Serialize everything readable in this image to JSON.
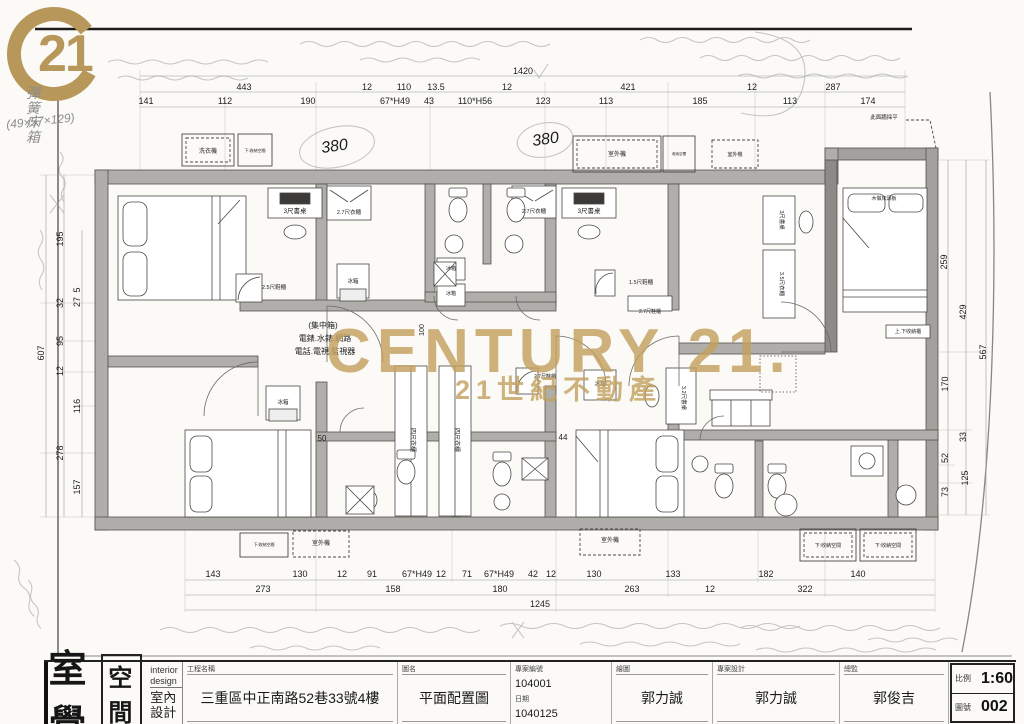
{
  "logo": {
    "number": "21"
  },
  "watermark": {
    "line1": "CENTURY 21.",
    "line2": "21世紀不動產"
  },
  "handwritten": {
    "spec_label": "彈簧床箱",
    "spec_note": "(49×57×129)",
    "circle1": "380",
    "circle2": "380"
  },
  "title_block": {
    "company_name": "室覺",
    "company_box": "空間",
    "company_en": "interior design",
    "company_cn": "室內設計",
    "f_project_label": "工程名稱",
    "f_project_value": "三重區中正南路52巷33號4樓",
    "f_drawing_label": "圖名",
    "f_drawing_value": "平面配置圖",
    "f_case_label": "專案編號",
    "f_case_value": "104001",
    "f_date_label": "日期",
    "f_date_value": "1040125",
    "f_draft_label": "繪圖",
    "f_draft_value": "郭力誠",
    "f_design_label": "專案設計",
    "f_design_value": "郭力誠",
    "f_director_label": "總監",
    "f_director_value": "郭俊吉",
    "f_scale_label": "比例",
    "f_scale_value": "1:60",
    "f_sheet_label": "圖號",
    "f_sheet_value": "002"
  },
  "plan": {
    "dim_labels": [
      {
        "t": "1420",
        "x": 523,
        "y": 74
      },
      {
        "t": "443",
        "x": 244,
        "y": 90
      },
      {
        "t": "12",
        "x": 367,
        "y": 90
      },
      {
        "t": "110",
        "x": 404,
        "y": 90
      },
      {
        "t": "13.5",
        "x": 436,
        "y": 90
      },
      {
        "t": "12",
        "x": 507,
        "y": 90
      },
      {
        "t": "421",
        "x": 628,
        "y": 90
      },
      {
        "t": "12",
        "x": 752,
        "y": 90
      },
      {
        "t": "287",
        "x": 833,
        "y": 90
      },
      {
        "t": "141",
        "x": 146,
        "y": 104
      },
      {
        "t": "112",
        "x": 225,
        "y": 104
      },
      {
        "t": "190",
        "x": 308,
        "y": 104
      },
      {
        "t": "67*H49",
        "x": 395,
        "y": 104
      },
      {
        "t": "43",
        "x": 429,
        "y": 104
      },
      {
        "t": "110*H56",
        "x": 475,
        "y": 104
      },
      {
        "t": "123",
        "x": 543,
        "y": 104
      },
      {
        "t": "113",
        "x": 606,
        "y": 104
      },
      {
        "t": "185",
        "x": 700,
        "y": 104
      },
      {
        "t": "113",
        "x": 790,
        "y": 104
      },
      {
        "t": "174",
        "x": 868,
        "y": 104
      },
      {
        "t": "143",
        "x": 213,
        "y": 577
      },
      {
        "t": "130",
        "x": 300,
        "y": 577
      },
      {
        "t": "12",
        "x": 342,
        "y": 577
      },
      {
        "t": "91",
        "x": 372,
        "y": 577
      },
      {
        "t": "67*H49",
        "x": 417,
        "y": 577
      },
      {
        "t": "12",
        "x": 441,
        "y": 577
      },
      {
        "t": "71",
        "x": 467,
        "y": 577
      },
      {
        "t": "67*H49",
        "x": 499,
        "y": 577
      },
      {
        "t": "42",
        "x": 533,
        "y": 577
      },
      {
        "t": "12",
        "x": 551,
        "y": 577
      },
      {
        "t": "130",
        "x": 594,
        "y": 577
      },
      {
        "t": "133",
        "x": 673,
        "y": 577
      },
      {
        "t": "182",
        "x": 766,
        "y": 577
      },
      {
        "t": "140",
        "x": 858,
        "y": 577
      },
      {
        "t": "273",
        "x": 263,
        "y": 592
      },
      {
        "t": "158",
        "x": 393,
        "y": 592
      },
      {
        "t": "180",
        "x": 500,
        "y": 592
      },
      {
        "t": "263",
        "x": 632,
        "y": 592
      },
      {
        "t": "12",
        "x": 710,
        "y": 592
      },
      {
        "t": "322",
        "x": 805,
        "y": 592
      },
      {
        "t": "1245",
        "x": 540,
        "y": 607
      },
      {
        "t": "607",
        "x": 44,
        "y": 353,
        "r": -90
      },
      {
        "t": "195",
        "x": 63,
        "y": 239,
        "r": -90
      },
      {
        "t": "32",
        "x": 63,
        "y": 303,
        "r": -90
      },
      {
        "t": "5",
        "x": 80,
        "y": 290,
        "r": -90
      },
      {
        "t": "27",
        "x": 80,
        "y": 302,
        "r": -90
      },
      {
        "t": "95",
        "x": 63,
        "y": 341,
        "r": -90
      },
      {
        "t": "12",
        "x": 63,
        "y": 371,
        "r": -90
      },
      {
        "t": "116",
        "x": 80,
        "y": 406,
        "r": -90
      },
      {
        "t": "278",
        "x": 63,
        "y": 453,
        "r": -90
      },
      {
        "t": "157",
        "x": 80,
        "y": 487,
        "r": -90
      },
      {
        "t": "259",
        "x": 947,
        "y": 262,
        "r": -90
      },
      {
        "t": "429",
        "x": 966,
        "y": 312,
        "r": -90
      },
      {
        "t": "567",
        "x": 986,
        "y": 352,
        "r": -90
      },
      {
        "t": "170",
        "x": 948,
        "y": 384,
        "r": -90
      },
      {
        "t": "33",
        "x": 966,
        "y": 437,
        "r": -90
      },
      {
        "t": "52",
        "x": 948,
        "y": 458,
        "r": -90
      },
      {
        "t": "125",
        "x": 968,
        "y": 478,
        "r": -90
      },
      {
        "t": "73",
        "x": 948,
        "y": 492,
        "r": -90
      },
      {
        "t": "50",
        "x": 322,
        "y": 441,
        "s": 8
      },
      {
        "t": "44",
        "x": 563,
        "y": 440,
        "s": 8
      },
      {
        "t": "100",
        "x": 424,
        "y": 330,
        "r": -90,
        "s": 7
      }
    ],
    "room_labels": [
      {
        "t": "洗衣機",
        "x": 208,
        "y": 153,
        "s": 6
      },
      {
        "t": "下:收納空間",
        "x": 255,
        "y": 152,
        "s": 4
      },
      {
        "t": "室外機",
        "x": 617,
        "y": 156,
        "s": 6
      },
      {
        "t": "收納空間",
        "x": 679,
        "y": 155,
        "s": 3.6
      },
      {
        "t": "室外機",
        "x": 735,
        "y": 156,
        "s": 5
      },
      {
        "t": "此面牆採平",
        "x": 884,
        "y": 119,
        "s": 5.5
      },
      {
        "t": "3尺書桌",
        "x": 295,
        "y": 213,
        "s": 6.5
      },
      {
        "t": "2.7尺衣櫃",
        "x": 349,
        "y": 214,
        "s": 5.5
      },
      {
        "t": "3尺書桌",
        "x": 589,
        "y": 213,
        "s": 6.5
      },
      {
        "t": "2.7尺衣櫃",
        "x": 534,
        "y": 213,
        "s": 5.5
      },
      {
        "t": "3尺書桌",
        "x": 780,
        "y": 220,
        "s": 5.5,
        "r": 90
      },
      {
        "t": "3.5尺衣櫃",
        "x": 780,
        "y": 284,
        "s": 5.5,
        "r": 90
      },
      {
        "t": "木做床頭板",
        "x": 884,
        "y": 200,
        "s": 5
      },
      {
        "t": "冰箱",
        "x": 451,
        "y": 270,
        "s": 5
      },
      {
        "t": "冰箱",
        "x": 451,
        "y": 295,
        "s": 5
      },
      {
        "t": "冰箱",
        "x": 353,
        "y": 283,
        "s": 5.5
      },
      {
        "t": "1.5尺鞋櫃",
        "x": 641,
        "y": 284,
        "s": 5.5
      },
      {
        "t": "2.5尺鞋櫃",
        "x": 274,
        "y": 289,
        "s": 5.5
      },
      {
        "t": "2.7尺鞋櫃",
        "x": 650,
        "y": 313,
        "s": 5
      },
      {
        "t": "(集中箱)",
        "x": 323,
        "y": 328,
        "s": 8
      },
      {
        "t": "電錶.水錶.網路",
        "x": 325,
        "y": 341,
        "s": 8
      },
      {
        "t": "電話.電視.監視器",
        "x": 325,
        "y": 354,
        "s": 8
      },
      {
        "t": "四尺衣櫃",
        "x": 411,
        "y": 440,
        "s": 6,
        "r": 90
      },
      {
        "t": "四尺衣櫃",
        "x": 455,
        "y": 440,
        "s": 6,
        "r": 90
      },
      {
        "t": "冰箱",
        "x": 283,
        "y": 404,
        "s": 5.5
      },
      {
        "t": "2.7尺鞋櫃",
        "x": 545,
        "y": 378,
        "s": 5
      },
      {
        "t": "冰箱",
        "x": 600,
        "y": 386,
        "s": 5.5
      },
      {
        "t": "3.2尺書桌",
        "x": 682,
        "y": 398,
        "s": 5.5,
        "r": 90
      },
      {
        "t": "上.下收納櫃",
        "x": 908,
        "y": 333,
        "s": 5
      },
      {
        "t": "室外機",
        "x": 321,
        "y": 545,
        "s": 6
      },
      {
        "t": "下:收納空間",
        "x": 264,
        "y": 546,
        "s": 4
      },
      {
        "t": "室外機",
        "x": 610,
        "y": 542,
        "s": 6
      },
      {
        "t": "下:收納空間",
        "x": 828,
        "y": 547,
        "s": 5
      },
      {
        "t": "下:收納空間",
        "x": 888,
        "y": 547,
        "s": 5
      }
    ]
  }
}
